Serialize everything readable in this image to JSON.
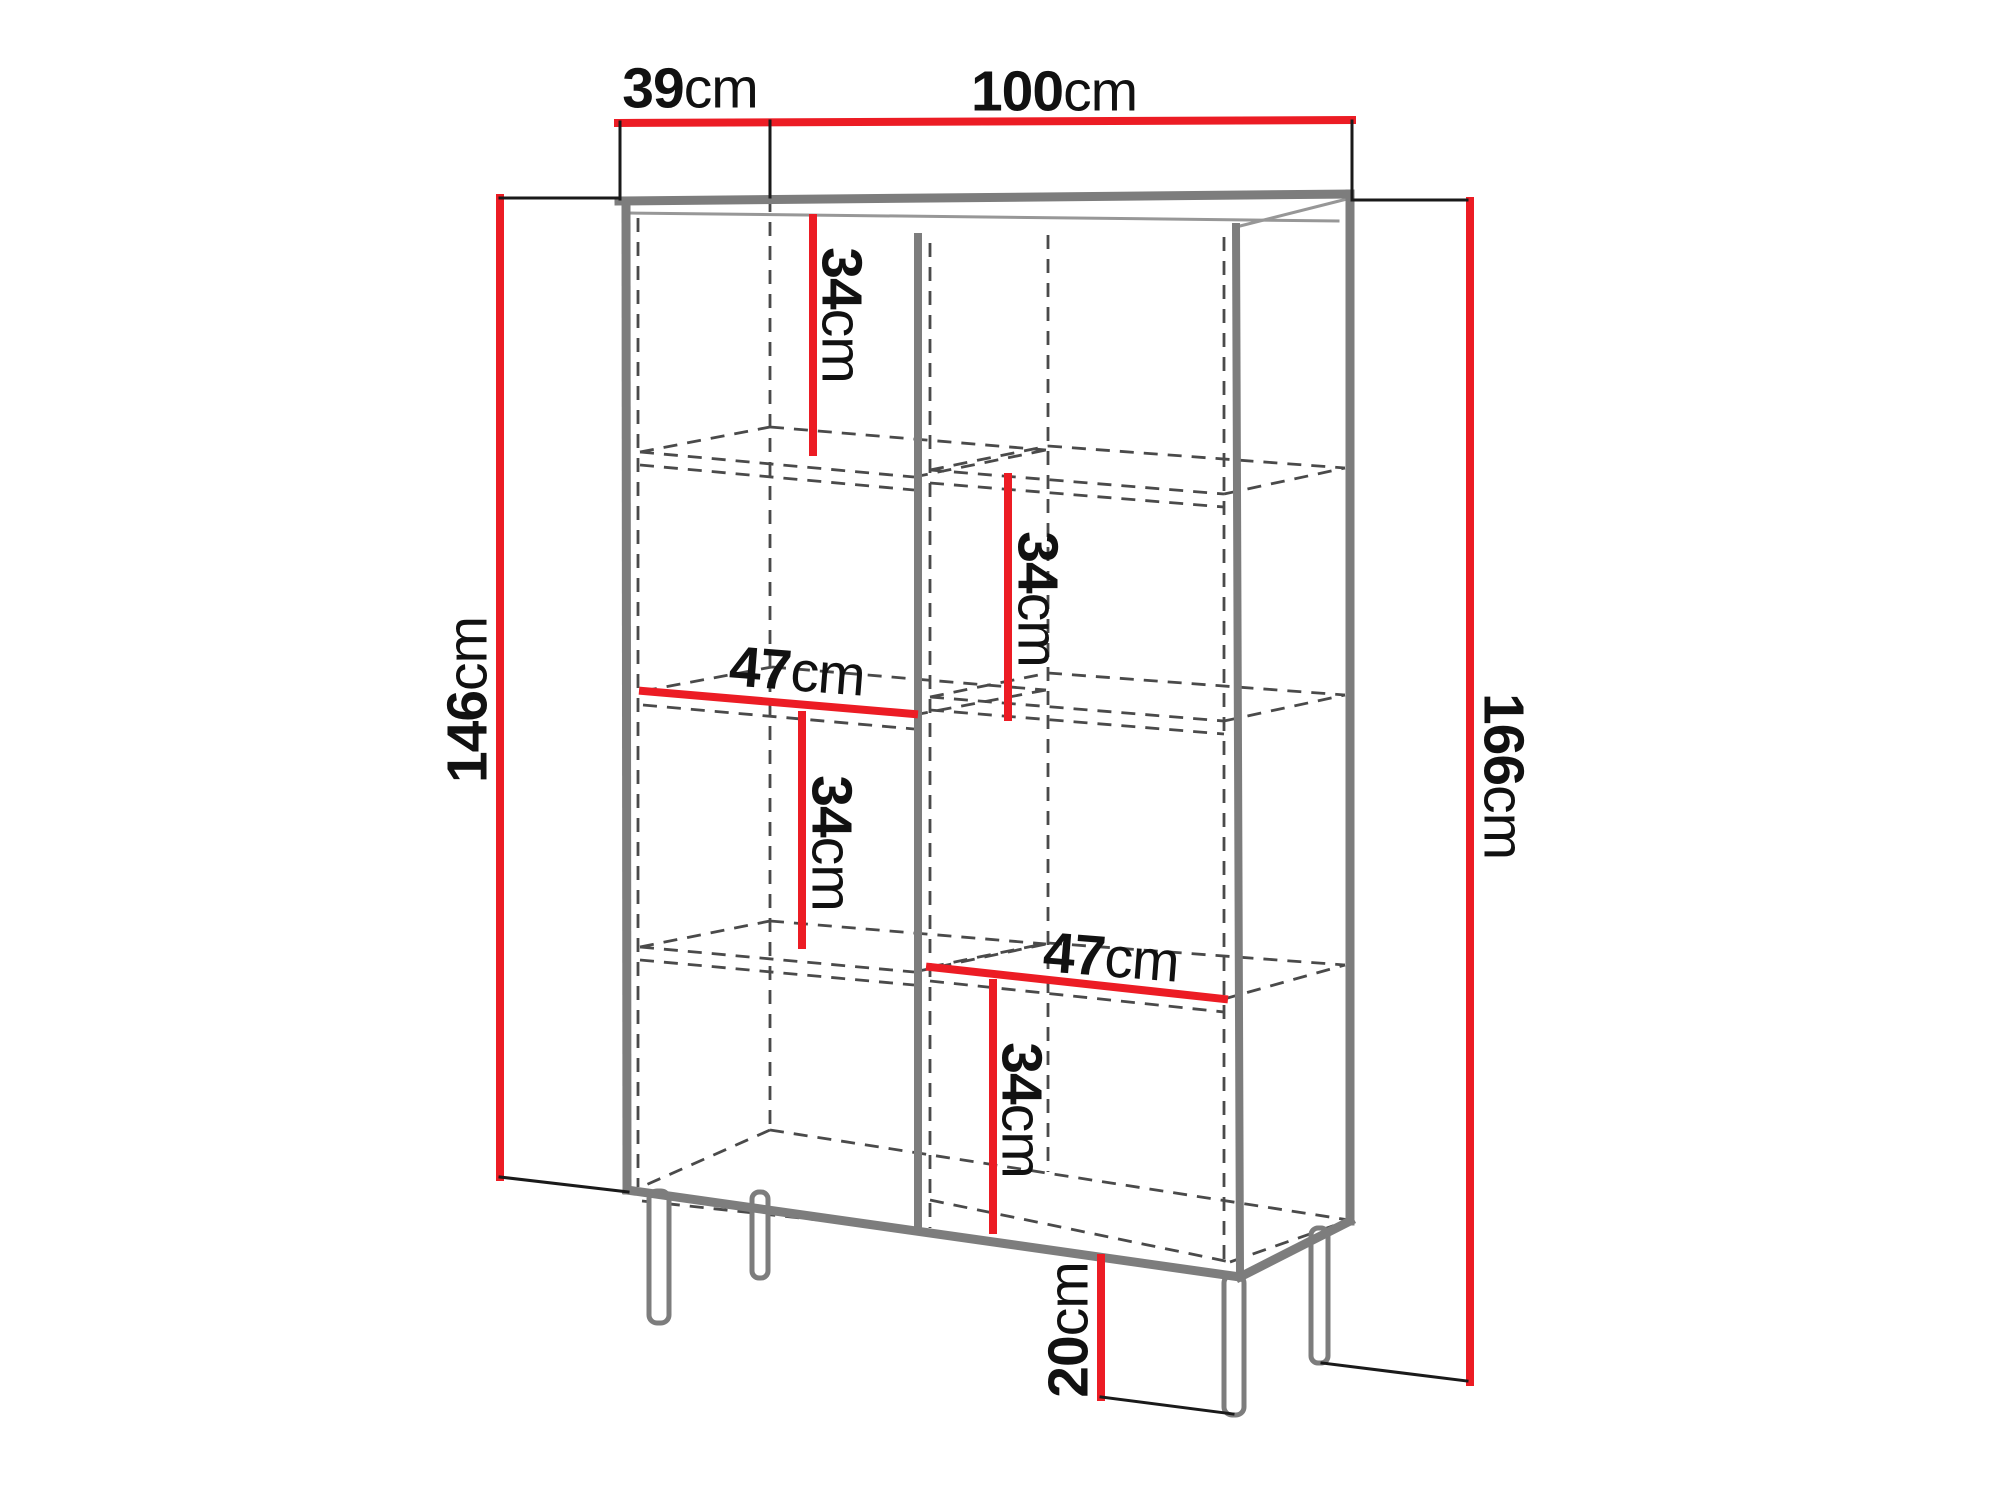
{
  "diagram": {
    "subject": "cabinet-dimension-drawing",
    "unit": "cm",
    "colors": {
      "dimension_line": "#EC1C24",
      "furniture_line": "#7d7d7d",
      "hidden_edge_line": "#4a4a4a",
      "extension_line": "#1a1a1a",
      "label_text": "#111111",
      "background": "#ffffff"
    },
    "dims": {
      "depth": {
        "value": "39",
        "unit": "cm"
      },
      "width": {
        "value": "100",
        "unit": "cm"
      },
      "body_height": {
        "value": "146",
        "unit": "cm"
      },
      "total_height": {
        "value": "166",
        "unit": "cm"
      },
      "leg_height": {
        "value": "20",
        "unit": "cm"
      },
      "shelf_width_left": {
        "value": "47",
        "unit": "cm"
      },
      "shelf_width_right": {
        "value": "47",
        "unit": "cm"
      },
      "gap_left_top": {
        "value": "34",
        "unit": "cm"
      },
      "gap_left_middle": {
        "value": "34",
        "unit": "cm"
      },
      "gap_right_upper": {
        "value": "34",
        "unit": "cm"
      },
      "gap_right_lower": {
        "value": "34",
        "unit": "cm"
      }
    }
  }
}
